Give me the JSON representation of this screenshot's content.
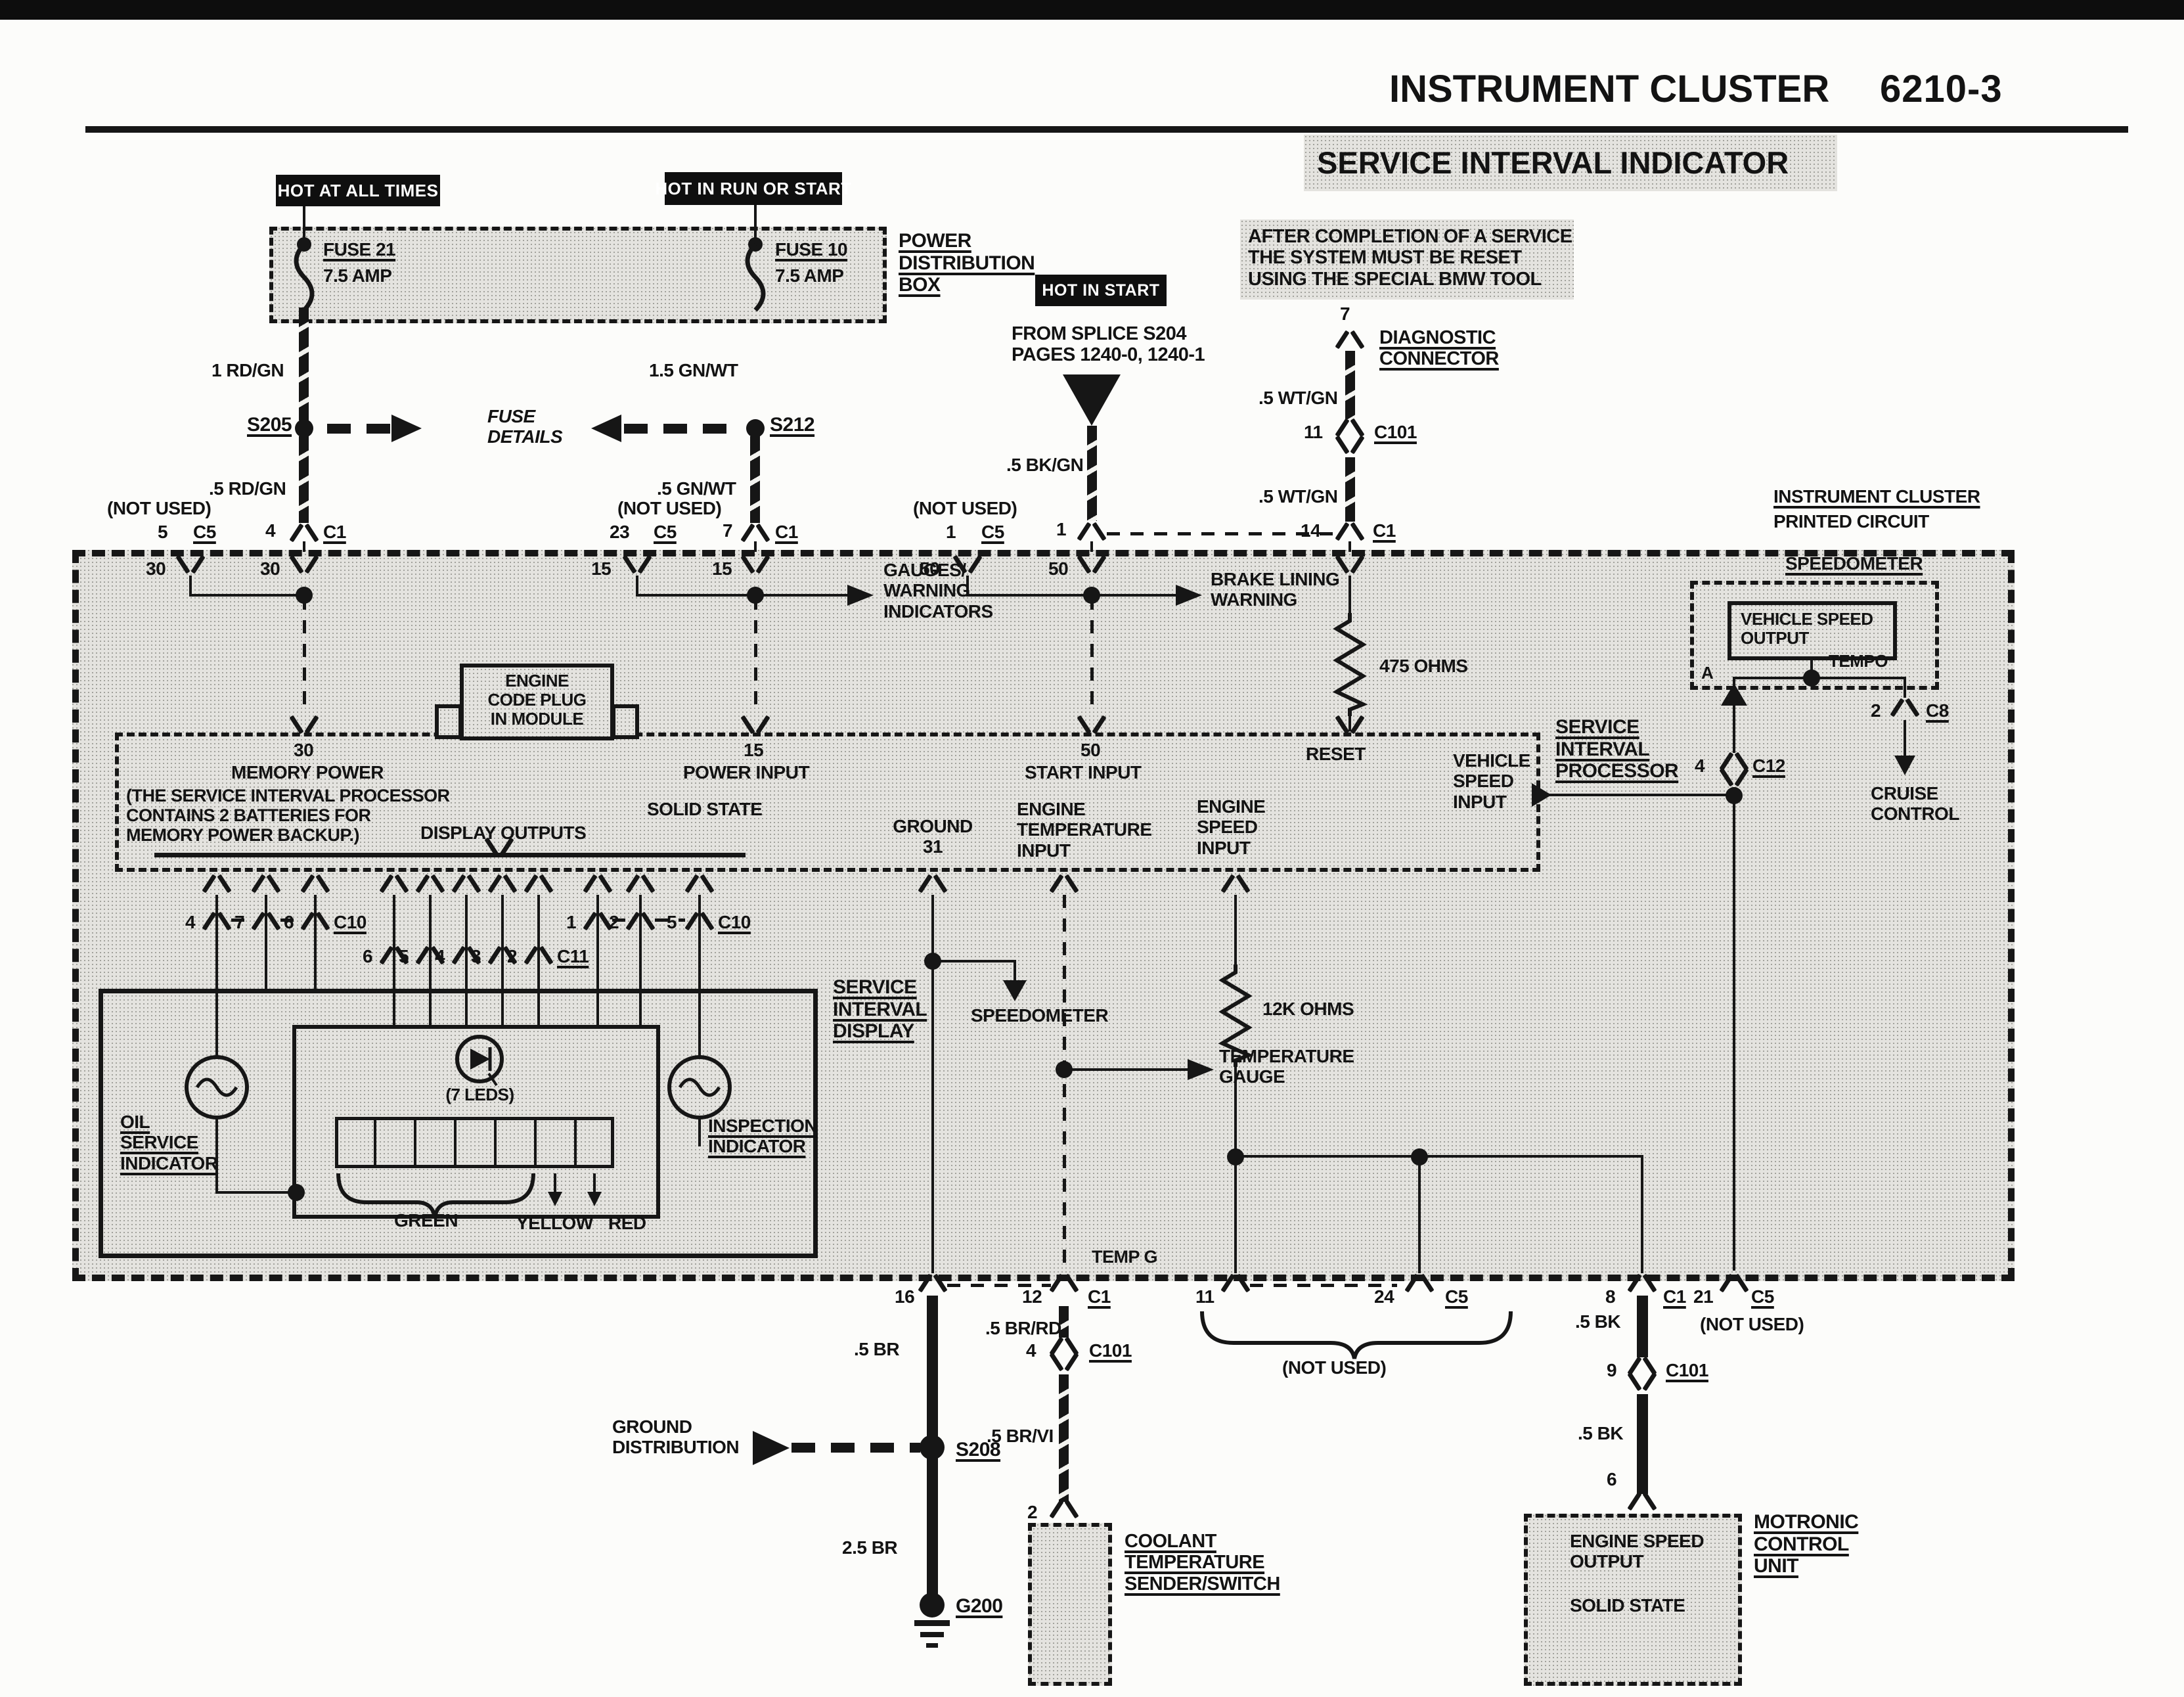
{
  "header": {
    "title": "INSTRUMENT CLUSTER",
    "page_no": "6210-3",
    "subtitle": "SERVICE INTERVAL INDICATOR"
  },
  "notes": {
    "reset_note": "AFTER COMPLETION OF A SERVICE\nTHE SYSTEM MUST BE RESET\nUSING THE SPECIAL BMW TOOL",
    "from_splice": "FROM SPLICE S204\nPAGES 1240-0, 1240-1",
    "splice_s": "S",
    "cluster1": "INSTRUMENT CLUSTER",
    "cluster2": "PRINTED CIRCUIT"
  },
  "power": {
    "hot_all": "HOT AT ALL TIMES",
    "hot_run": "HOT IN RUN OR START",
    "hot_start": "HOT IN START",
    "box_label": "POWER\nDISTRIBUTION\nBOX",
    "fuse21": "FUSE 21",
    "fuse21_amp": "7.5 AMP",
    "fuse10": "FUSE 10",
    "fuse10_amp": "7.5 AMP",
    "fuse_details": "FUSE\nDETAILS",
    "s205": "S205",
    "s212": "S212"
  },
  "wires": {
    "rd_gn_1": "1 RD/GN",
    "rd_gn_5": ".5 RD/GN",
    "gn_wt_15": "1.5 GN/WT",
    "gn_wt_5": ".5 GN/WT",
    "bk_gn": ".5 BK/GN",
    "wt_gn_a": ".5 WT/GN",
    "wt_gn_b": ".5 WT/GN",
    "br_5": ".5 BR",
    "br_25": "2.5 BR",
    "br_rd": ".5 BR/RD",
    "br_vi": ".5 BR/VI",
    "bk_a": ".5 BK",
    "bk_b": ".5 BK"
  },
  "num": {
    "1": "1",
    "2": "2",
    "3": "3",
    "4": "4",
    "5": "5",
    "6": "6",
    "7": "7",
    "8": "8",
    "9": "9",
    "11": "11",
    "12": "12",
    "14": "14",
    "15": "15",
    "16": "16",
    "21": "21",
    "23": "23",
    "24": "24",
    "30": "30",
    "50": "50"
  },
  "conn": {
    "c1": "C1",
    "c5": "C5",
    "c8": "C8",
    "c10": "C10",
    "c11": "C11",
    "c12": "C12",
    "c101": "C101"
  },
  "proc": {
    "title": "SERVICE\nINTERVAL\nPROCESSOR",
    "memory_power": "MEMORY POWER",
    "power_input": "POWER INPUT",
    "start_input": "START INPUT",
    "reset": "RESET",
    "solid_state": "SOLID STATE",
    "battery_note": "(THE SERVICE INTERVAL PROCESSOR\nCONTAINS 2 BATTERIES FOR\nMEMORY POWER BACKUP.)",
    "display_outputs": "DISPLAY OUTPUTS",
    "ground": "GROUND\n31",
    "engine_temp": "ENGINE\nTEMPERATURE\nINPUT",
    "engine_speed": "ENGINE\nSPEED\nINPUT",
    "vehicle_speed": "VEHICLE\nSPEED\nINPUT",
    "code_plug": "ENGINE\nCODE PLUG\nIN MODULE",
    "r475": "475 OHMS",
    "r12k": "12K OHMS"
  },
  "branches": {
    "gauges": "GAUGES/\nWARNING\nINDICATORS",
    "brake": "BRAKE LINING\nWARNING",
    "speedo_arrow": "SPEEDOMETER",
    "temp_gauge": "TEMPERATURE\nGAUGE",
    "temp_g": "TEMP G",
    "cruise": "CRUISE\nCONTROL",
    "tempo": "TEMPO",
    "a": "A"
  },
  "display": {
    "title": "SERVICE\nINTERVAL\nDISPLAY",
    "oil": "OIL\nSERVICE\nINDICATOR",
    "inspection": "INSPECTION\nINDICATOR",
    "leds": "(7 LEDS)",
    "green": "GREEN",
    "yellow": "YELLOW",
    "red": "RED"
  },
  "speedo": {
    "label": "SPEEDOMETER",
    "vso": "VEHICLE SPEED\nOUTPUT"
  },
  "bottom": {
    "ground_dist": "GROUND\nDISTRIBUTION",
    "s208": "S208",
    "g200": "G200",
    "coolant": "COOLANT\nTEMPERATURE\nSENDER/SWITCH",
    "motronic": "MOTRONIC\nCONTROL\nUNIT",
    "eng_speed_out": "ENGINE SPEED\nOUTPUT",
    "solid_state": "SOLID STATE",
    "diag": "DIAGNOSTIC\nCONNECTOR"
  },
  "misc": {
    "not_used": "(NOT USED)"
  }
}
